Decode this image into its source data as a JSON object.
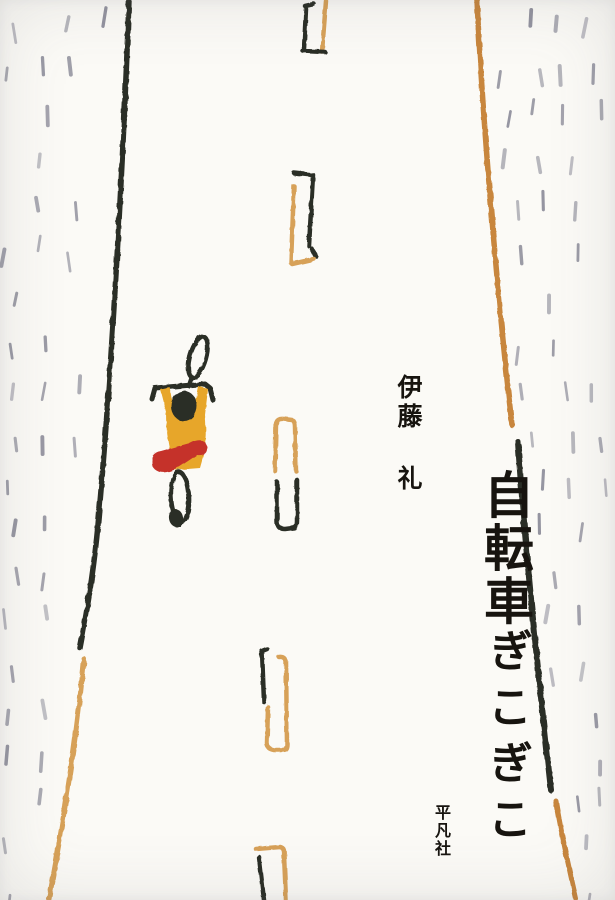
{
  "cover": {
    "title_kanji": "自転車",
    "title_kana": "ぎこぎこ",
    "author": "伊藤 礼",
    "publisher": "平凡社"
  },
  "colors": {
    "background": "#fbfaf6",
    "text_black": "#17140f",
    "ink_black": "#2b2e25",
    "crayon_orange": "#c8863c",
    "crayon_tan": "#d7a158",
    "rain_gray": "#8d8d9a",
    "rider_yellow": "#e7a62a",
    "rider_red": "#c53029"
  }
}
